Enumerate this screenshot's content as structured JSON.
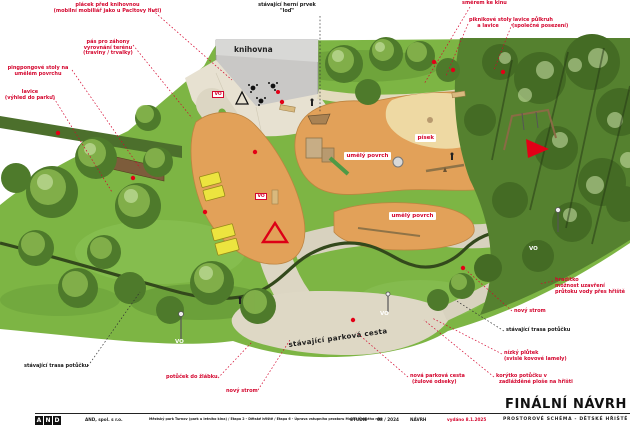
{
  "colors": {
    "accent_red": "#d4062e",
    "grass_green": "#7db544",
    "play_surface_orange": "#e2a159",
    "sand_yellow": "#eed9a3",
    "path_beige": "#dbd5c2",
    "building_gray": "#c9c8c6",
    "stream_dark_green": "#33491c"
  },
  "drawing": {
    "building_label": "knihovna",
    "vo_label": "VO",
    "surface_labels": {
      "pisek": "písek",
      "umely_povrch_1": "umělý povrch",
      "umely_povrch_2": "umělý povrch"
    },
    "path_label": "stávající parková cesta"
  },
  "annotations": {
    "placek": {
      "lines": [
        "plácek před knihovnou",
        "(mobilní mobiliář jako u Pacltovy huti)"
      ]
    },
    "pas_zahony": {
      "lines": [
        "pás pro záhony",
        "vyrovnání terénu",
        "(traviny / trvalky)"
      ]
    },
    "pingpong": {
      "lines": [
        "pingpongové stoly na",
        "umělém povrchu"
      ]
    },
    "lavice_vyhled": {
      "lines": [
        "lavice",
        "(výhled do parku)"
      ]
    },
    "herni_prvek": {
      "lines": [
        "stávající herní prvek",
        "\"loď\""
      ]
    },
    "smerem_ke_kinu": {
      "lines": [
        "směrem ke kinu"
      ]
    },
    "piknikove": {
      "lines": [
        "piknikové stoly",
        "a lavice"
      ]
    },
    "lavice_pulkruh": {
      "lines": [
        "lavice půlkruh",
        "(společné posezení)"
      ]
    },
    "hraditko": {
      "lines": [
        "hradítko",
        "možnost uzavření",
        "průtoku vody přes hřiště"
      ]
    },
    "novy_strom_right": {
      "lines": [
        "nový strom"
      ]
    },
    "stav_trasa_right": {
      "lines": [
        "stávající trasa potůčku"
      ]
    },
    "nizky_plutek": {
      "lines": [
        "nízký plůtek",
        "(svislé kovové lamely)"
      ]
    },
    "korytko": {
      "lines": [
        "korýtko potůčku v",
        "zadlážděné ploše na hřišti"
      ]
    },
    "nova_parkova": {
      "lines": [
        "nová parková cesta",
        "(žulové odseky)"
      ]
    },
    "novy_strom_bottom": {
      "lines": [
        "nový strom"
      ]
    },
    "potucek_zlabek": {
      "lines": [
        "potůček do žlábku"
      ]
    },
    "stav_trasa_left": {
      "lines": [
        "stávající trasa potůčku"
      ]
    }
  },
  "titleblock": {
    "final_title": "FINÁLNÍ NÁVRH",
    "logo_letters": [
      "A",
      "N",
      "D"
    ],
    "company": "AND, spol. s r.o.",
    "project": "Městský park Turnov (park u letního kina) / Etapa 2 - Dětské hřiště / Etapa 6 - Úprava vstupního prostoru Muzea Českého ráje",
    "phase": "STUDIE",
    "date": "08 / 2024",
    "stage": "NÁVRH",
    "issued": "vydáno 8.1.2025",
    "scheme": "PROSTOROVÉ SCHÉMA - DĚTSKÉ HŘIŠTĚ"
  }
}
